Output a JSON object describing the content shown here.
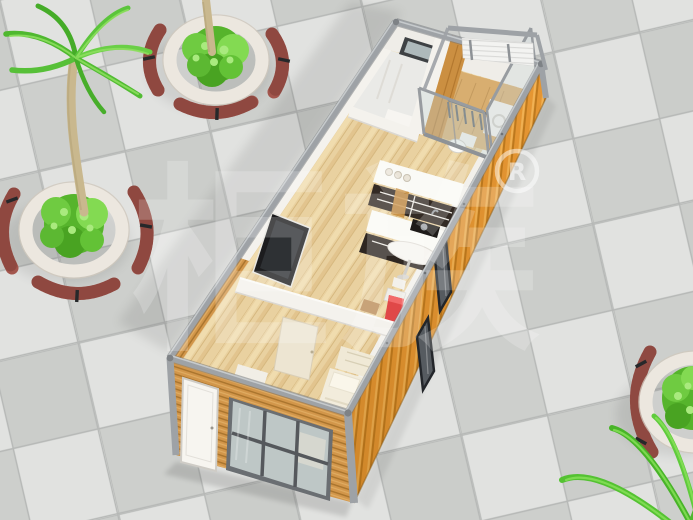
{
  "scene": {
    "type": "3d-architectural-render",
    "subject": "Aerial cutaway view of a flat-pack container house interior on a tiled plaza with circular planters, curved benches and palm trees",
    "watermark": {
      "brand_text": "柜族",
      "registered_letter": "R"
    },
    "palette": {
      "tile_light": "#E1E2E0",
      "tile_dark": "#CBCDCA",
      "tile_grout": "#B6B8B6",
      "steel_frame": "#9EA2A6",
      "steel_dark": "#6F7377",
      "container_orange": "#E79733",
      "corrugation_ridge": "#BF7A1E",
      "corrugation_light": "#F4B455",
      "facade_wood": "#D2964A",
      "facade_wood_dark": "#A9742D",
      "interior_wall": "#F4F2ED",
      "wall_shadow": "#DBD8D2",
      "wood_floor": "#E9D1A0",
      "wood_floor_line": "#D6B87F",
      "balcony_floor": "#D8AE70",
      "bathroom_floor": "#EAEAE7",
      "cabinet_dark": "#332A24",
      "counter_white": "#FAFAF6",
      "tv_black": "#1C1C1E",
      "bed_cream": "#F2ECDC",
      "door_cream": "#EDE5D2",
      "accent_red": "#E04848",
      "glass": "#C6D4D6",
      "window_frame": "#3E4144",
      "planter_stone": "#ECE7DF",
      "bench_wood": "#A3564D",
      "bench_slat": "#7C3C35",
      "bench_metal": "#26282A",
      "foliage": "#56B42C",
      "foliage_light": "#83DA52",
      "foliage_highlight": "#A9EA7E",
      "palm_green": "#52BC33",
      "palm_trunk": "#C9B88E"
    },
    "house": {
      "rooms": [
        "bathroom",
        "balcony",
        "kitchen",
        "living-area",
        "bedroom"
      ],
      "furniture": [
        "wall-mounted-tv",
        "kitchen-upper-cabinets",
        "kitchen-counter",
        "cooktop",
        "bar-table",
        "bar-stool",
        "refrigerator",
        "washing-machine",
        "toilet",
        "vanity-shelf",
        "bed",
        "pillow",
        "bedside-shelf",
        "interior-door",
        "entry-door",
        "sliding-glass-window",
        "bathroom-window",
        "balcony-railing",
        "glass-partition"
      ]
    },
    "landscape": {
      "planter_count": 3,
      "palm_tree_count": 2,
      "bench_style": "curved wooden benches with black metal armrests around circular stone planters"
    }
  }
}
